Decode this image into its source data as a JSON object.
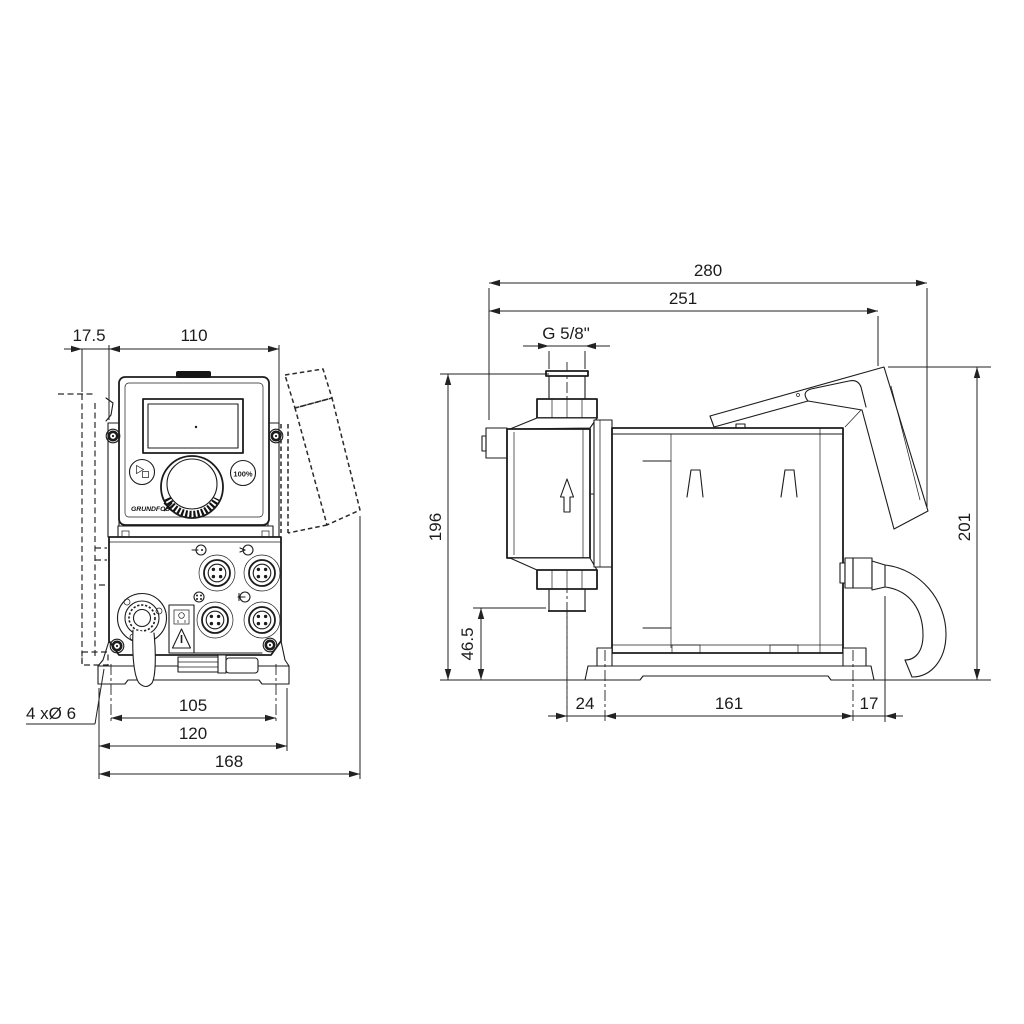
{
  "drawing": {
    "front_view": {
      "dims": {
        "wall_clearance": "17.5",
        "body_width": "110",
        "mount_hole_pitch": "105",
        "plate_width": "120",
        "overall_width": "168",
        "mount_holes": "4 xØ 6"
      },
      "panel": {
        "full_capacity_button": "100%",
        "brand_logo": "GRUNDFOS"
      }
    },
    "side_view": {
      "dims": {
        "overall_depth": "280",
        "depth_to_hood_edge": "251",
        "connection_thread": "G 5/8\"",
        "height_to_connection": "196",
        "connection_height": "46.5",
        "front_overhang": "24",
        "foot_pitch": "161",
        "rear_overhang": "17",
        "overall_height": "201"
      }
    }
  }
}
